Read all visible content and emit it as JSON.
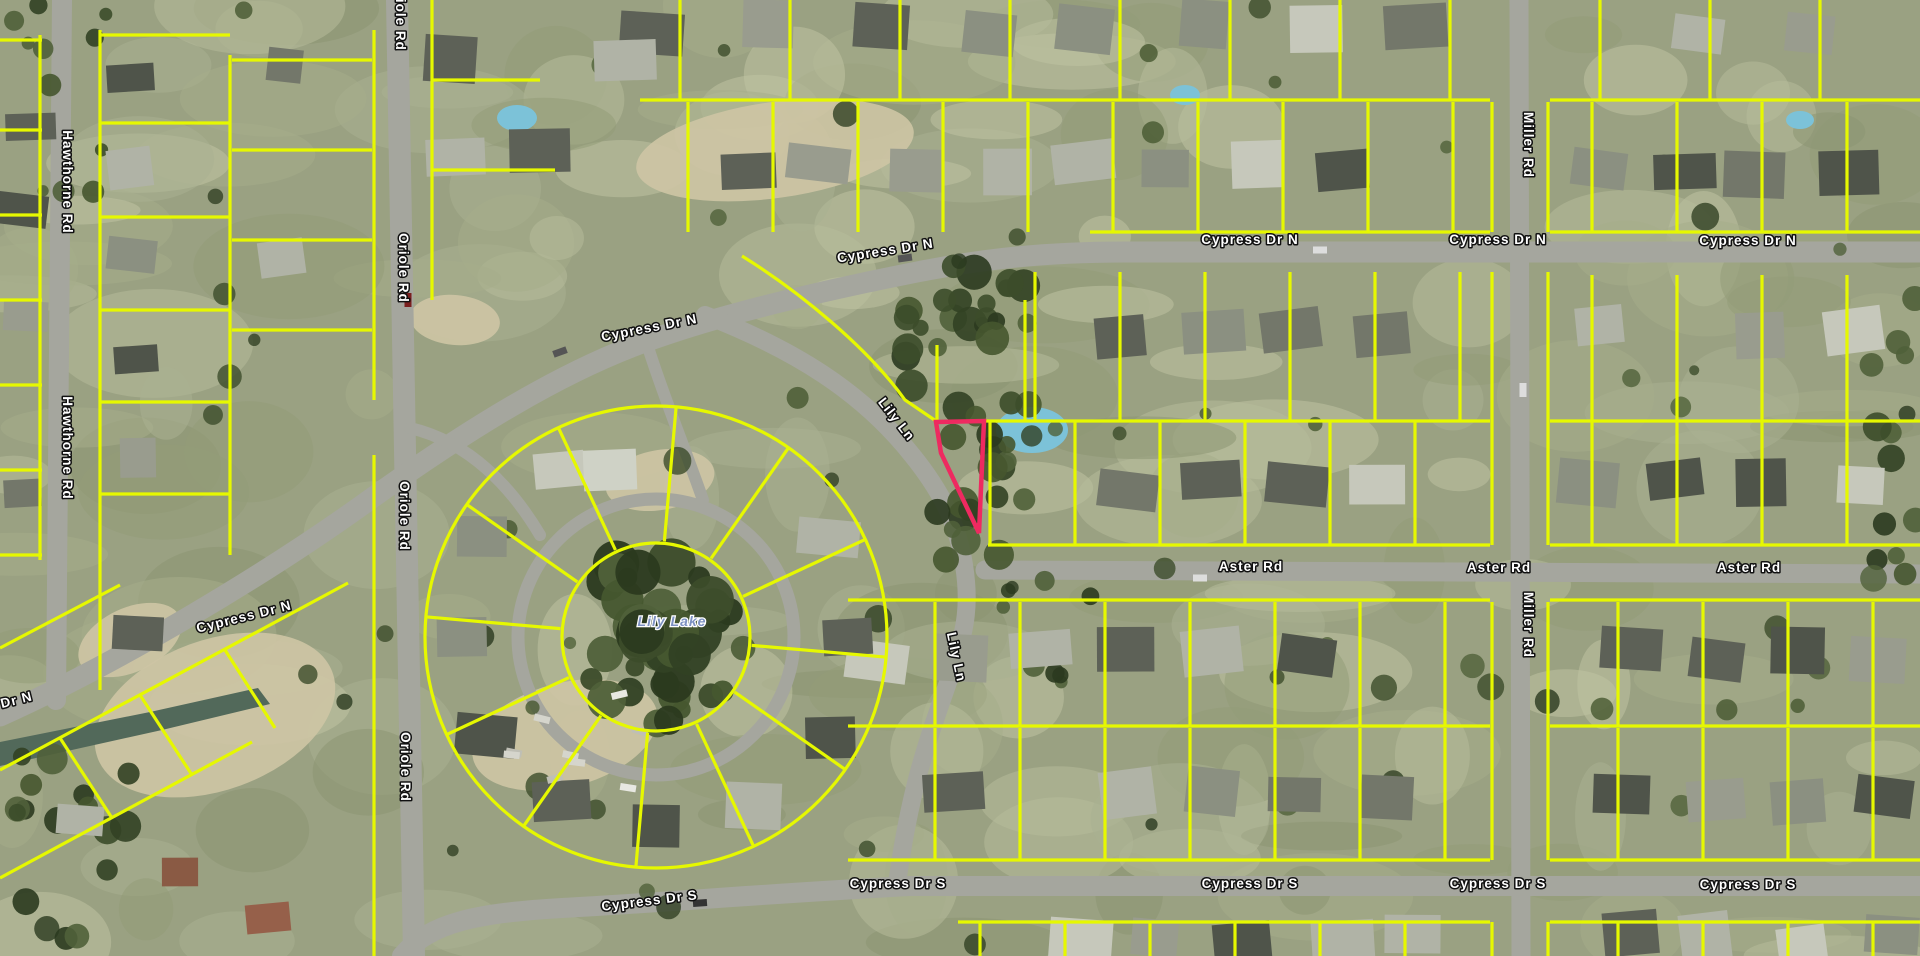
{
  "map": {
    "kind": "aerial-parcel-map",
    "width": 1920,
    "height": 956,
    "colors": {
      "parcel_line": "#e6f800",
      "highlight_parcel": "#ee2a60",
      "road_fill": "#a5a69e",
      "label_fill": "#ffffff",
      "label_halo": "#111111",
      "lake_label_color": "#7d91c2"
    },
    "street_labels": [
      {
        "text": "Hawthorne Rd",
        "x": 63,
        "y": 182,
        "rot": 90
      },
      {
        "text": "Hawthorne Rd",
        "x": 63,
        "y": 448,
        "rot": 90
      },
      {
        "text": "Oriole Rd",
        "x": 396,
        "y": 16,
        "rot": 90
      },
      {
        "text": "Oriole Rd",
        "x": 399,
        "y": 268,
        "rot": 90
      },
      {
        "text": "Oriole Rd",
        "x": 400,
        "y": 516,
        "rot": 90
      },
      {
        "text": "Oriole Rd",
        "x": 401,
        "y": 767,
        "rot": 90
      },
      {
        "text": "Cypress Dr N",
        "x": 245,
        "y": 621,
        "rot": -14
      },
      {
        "text": "Cypress Dr N",
        "x": -14,
        "y": 712,
        "rot": -14
      },
      {
        "text": "Cypress Dr N",
        "x": 650,
        "y": 332,
        "rot": -11
      },
      {
        "text": "Cypress Dr N",
        "x": 886,
        "y": 255,
        "rot": -9
      },
      {
        "text": "Cypress Dr N",
        "x": 1250,
        "y": 244,
        "rot": 0
      },
      {
        "text": "Cypress Dr N",
        "x": 1498,
        "y": 244,
        "rot": 0
      },
      {
        "text": "Cypress Dr N",
        "x": 1748,
        "y": 245,
        "rot": 0
      },
      {
        "text": "Lily Ln",
        "x": 893,
        "y": 422,
        "rot": 52
      },
      {
        "text": "Lily Ln",
        "x": 952,
        "y": 658,
        "rot": 78
      },
      {
        "text": "Miller Rd",
        "x": 1524,
        "y": 145,
        "rot": 90
      },
      {
        "text": "Miller Rd",
        "x": 1524,
        "y": 625,
        "rot": 90
      },
      {
        "text": "Aster Rd",
        "x": 1251,
        "y": 571,
        "rot": 0
      },
      {
        "text": "Aster Rd",
        "x": 1499,
        "y": 572,
        "rot": 0
      },
      {
        "text": "Aster Rd",
        "x": 1749,
        "y": 572,
        "rot": 0
      },
      {
        "text": "Cypress Dr S",
        "x": 650,
        "y": 905,
        "rot": -7
      },
      {
        "text": "Cypress Dr S",
        "x": 898,
        "y": 888,
        "rot": 0
      },
      {
        "text": "Cypress Dr S",
        "x": 1250,
        "y": 888,
        "rot": 0
      },
      {
        "text": "Cypress Dr S",
        "x": 1498,
        "y": 888,
        "rot": 0
      },
      {
        "text": "Cypress Dr S",
        "x": 1748,
        "y": 889,
        "rot": 0
      }
    ],
    "lake_label": {
      "text": "Lily Lake",
      "x": 672,
      "y": 626
    },
    "highlight_parcel": {
      "points": "936,422 984,421 979,533 941,453",
      "color": "#ee2a60"
    }
  }
}
